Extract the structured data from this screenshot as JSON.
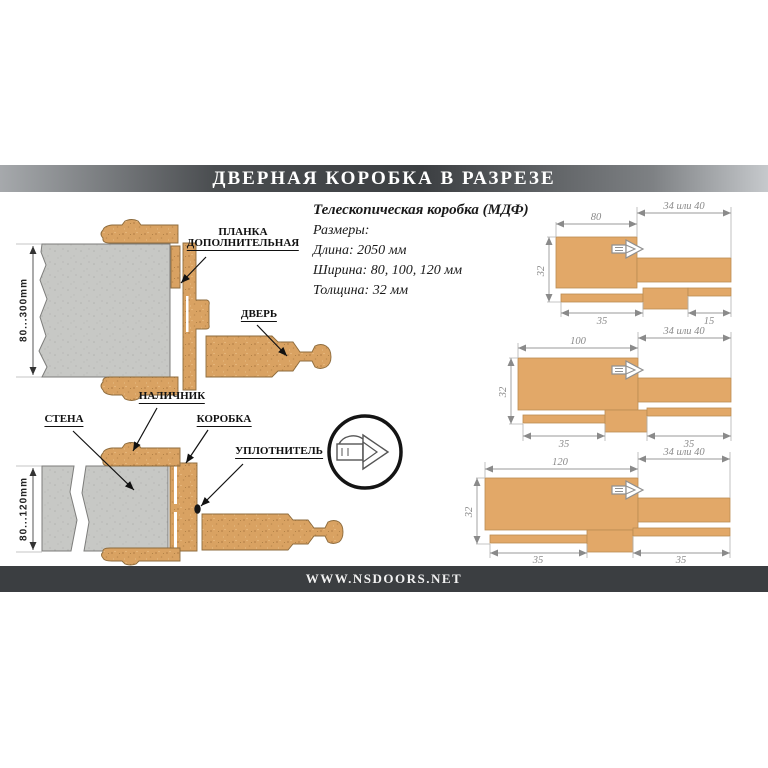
{
  "title_bar": {
    "text": "ДВЕРНАЯ КОРОБКА В РАЗРЕЗЕ"
  },
  "footer_bar": {
    "url": "WWW.NSDOORS.NET"
  },
  "specs": {
    "heading": "Телескопическая коробка (МДФ)",
    "sizes_label": "Размеры:",
    "length": "Длина: 2050 мм",
    "width": "Ширина: 80, 100, 120 мм",
    "thickness": "Толщина: 32 мм"
  },
  "section_top": {
    "wall_depth": "80...300mm",
    "label_plank_line1": "ПЛАНКА",
    "label_plank_line2": "ДОПОЛНИТЕЛЬНАЯ",
    "label_door": "ДВЕРЬ"
  },
  "section_bottom": {
    "wall_depth": "80...120mm",
    "label_casing": "НАЛИЧНИК",
    "label_wall": "СТЕНА",
    "label_frame": "КОРОБКА",
    "label_seal": "УПЛОТНИТЕЛЬ"
  },
  "profiles": [
    {
      "width": "80",
      "extension": "34 или 40",
      "thickness": "32",
      "groove_left": "35",
      "groove_right": "15"
    },
    {
      "width": "100",
      "extension": "34 или 40",
      "thickness": "32",
      "groove_left": "35",
      "groove_right": "35"
    },
    {
      "width": "120",
      "extension": "34 или 40",
      "thickness": "32",
      "groove_left": "35",
      "groove_right": "35"
    }
  ],
  "colors": {
    "wood": "#e2a868",
    "wood_speckle": "#b8834a",
    "wall_gray": "#c7c8c5",
    "bar_dark": "#3b3e41",
    "dim_gray": "#8a8a8a"
  }
}
